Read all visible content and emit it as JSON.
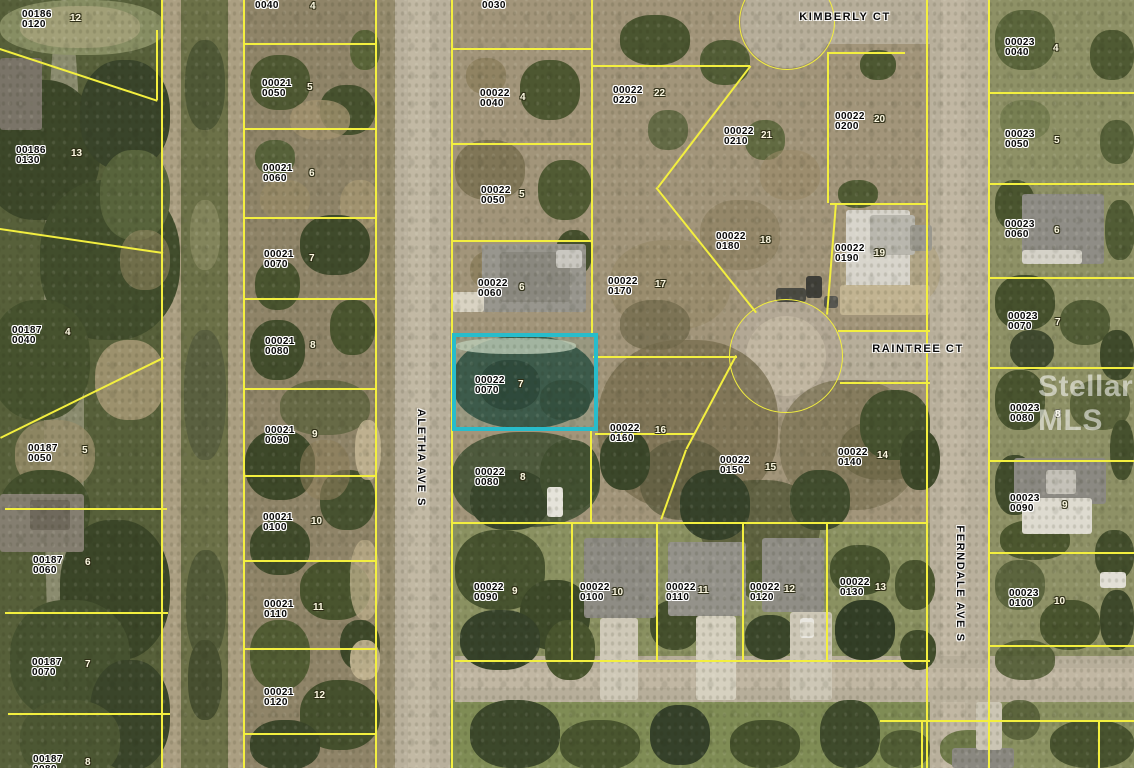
{
  "map_type": "aerial-parcel-map",
  "colors": {
    "boundary_line": "#f3ef3f",
    "highlight_border": "#28bccb",
    "parcel_label": "#050505",
    "lot_number": "#fdf9e3"
  },
  "watermark": {
    "text": "Stellar MLS"
  },
  "highlight": {
    "x": 452,
    "y": 333,
    "width": 146,
    "height": 98
  },
  "streets": [
    {
      "name": "KIMBERLY CT",
      "x": 845,
      "y": 17,
      "vertical": false
    },
    {
      "name": "RAINTREE CT",
      "x": 918,
      "y": 349,
      "vertical": false
    },
    {
      "name": "ALETHA AVE S",
      "x": 421,
      "y": 458,
      "vertical": true
    },
    {
      "name": "FERNDALE AVE S",
      "x": 960,
      "y": 584,
      "vertical": true
    }
  ],
  "parcels": [
    {
      "strap": "00186",
      "block": "0120",
      "x": 22,
      "y": 10
    },
    {
      "strap": "00186",
      "block": "0130",
      "x": 16,
      "y": 146
    },
    {
      "strap": "00187",
      "block": "0040",
      "x": 12,
      "y": 326
    },
    {
      "strap": "00187",
      "block": "0050",
      "x": 28,
      "y": 444
    },
    {
      "strap": "00187",
      "block": "0060",
      "x": 33,
      "y": 556
    },
    {
      "strap": "00187",
      "block": "0070",
      "x": 32,
      "y": 658
    },
    {
      "strap": "00187",
      "block": "0080",
      "x": 33,
      "y": 755
    },
    {
      "strap": "",
      "block": "0040",
      "x": 255,
      "y": 1
    },
    {
      "strap": "00021",
      "block": "0050",
      "x": 262,
      "y": 79
    },
    {
      "strap": "00021",
      "block": "0060",
      "x": 263,
      "y": 164
    },
    {
      "strap": "00021",
      "block": "0070",
      "x": 264,
      "y": 250
    },
    {
      "strap": "00021",
      "block": "0080",
      "x": 265,
      "y": 337
    },
    {
      "strap": "00021",
      "block": "0090",
      "x": 265,
      "y": 426
    },
    {
      "strap": "00021",
      "block": "0100",
      "x": 263,
      "y": 513
    },
    {
      "strap": "00021",
      "block": "0110",
      "x": 264,
      "y": 600
    },
    {
      "strap": "00021",
      "block": "0120",
      "x": 264,
      "y": 688
    },
    {
      "strap": "",
      "block": "0030",
      "x": 482,
      "y": 1
    },
    {
      "strap": "00022",
      "block": "0040",
      "x": 480,
      "y": 89
    },
    {
      "strap": "00022",
      "block": "0050",
      "x": 481,
      "y": 186
    },
    {
      "strap": "00022",
      "block": "0060",
      "x": 478,
      "y": 279
    },
    {
      "strap": "00022",
      "block": "0070",
      "x": 475,
      "y": 376
    },
    {
      "strap": "00022",
      "block": "0080",
      "x": 475,
      "y": 468
    },
    {
      "strap": "00022",
      "block": "0090",
      "x": 474,
      "y": 583
    },
    {
      "strap": "00022",
      "block": "0100",
      "x": 580,
      "y": 583
    },
    {
      "strap": "00022",
      "block": "0110",
      "x": 666,
      "y": 583
    },
    {
      "strap": "00022",
      "block": "0120",
      "x": 750,
      "y": 583
    },
    {
      "strap": "00022",
      "block": "0130",
      "x": 840,
      "y": 578
    },
    {
      "strap": "00022",
      "block": "0140",
      "x": 838,
      "y": 448
    },
    {
      "strap": "00022",
      "block": "0150",
      "x": 720,
      "y": 456
    },
    {
      "strap": "00022",
      "block": "0160",
      "x": 610,
      "y": 424
    },
    {
      "strap": "00022",
      "block": "0170",
      "x": 608,
      "y": 277
    },
    {
      "strap": "00022",
      "block": "0180",
      "x": 716,
      "y": 232
    },
    {
      "strap": "00022",
      "block": "0190",
      "x": 835,
      "y": 244
    },
    {
      "strap": "00022",
      "block": "0200",
      "x": 835,
      "y": 112
    },
    {
      "strap": "00022",
      "block": "0210",
      "x": 724,
      "y": 127
    },
    {
      "strap": "00022",
      "block": "0220",
      "x": 613,
      "y": 86
    },
    {
      "strap": "00023",
      "block": "0040",
      "x": 1005,
      "y": 38
    },
    {
      "strap": "00023",
      "block": "0050",
      "x": 1005,
      "y": 130
    },
    {
      "strap": "00023",
      "block": "0060",
      "x": 1005,
      "y": 220
    },
    {
      "strap": "00023",
      "block": "0070",
      "x": 1008,
      "y": 312
    },
    {
      "strap": "00023",
      "block": "0080",
      "x": 1010,
      "y": 404
    },
    {
      "strap": "00023",
      "block": "0090",
      "x": 1010,
      "y": 494
    },
    {
      "strap": "00023",
      "block": "0100",
      "x": 1009,
      "y": 589
    }
  ],
  "lots": [
    {
      "n": "12",
      "x": 70,
      "y": 14
    },
    {
      "n": "13",
      "x": 71,
      "y": 149
    },
    {
      "n": "4",
      "x": 65,
      "y": 328
    },
    {
      "n": "5",
      "x": 82,
      "y": 446
    },
    {
      "n": "6",
      "x": 85,
      "y": 558
    },
    {
      "n": "7",
      "x": 85,
      "y": 660
    },
    {
      "n": "8",
      "x": 85,
      "y": 758
    },
    {
      "n": "4",
      "x": 310,
      "y": 2
    },
    {
      "n": "5",
      "x": 307,
      "y": 83
    },
    {
      "n": "6",
      "x": 309,
      "y": 169
    },
    {
      "n": "7",
      "x": 309,
      "y": 254
    },
    {
      "n": "8",
      "x": 310,
      "y": 341
    },
    {
      "n": "9",
      "x": 312,
      "y": 430
    },
    {
      "n": "10",
      "x": 311,
      "y": 517
    },
    {
      "n": "11",
      "x": 313,
      "y": 603
    },
    {
      "n": "12",
      "x": 314,
      "y": 691
    },
    {
      "n": "4",
      "x": 520,
      "y": 93
    },
    {
      "n": "5",
      "x": 519,
      "y": 190
    },
    {
      "n": "6",
      "x": 519,
      "y": 283
    },
    {
      "n": "7",
      "x": 518,
      "y": 380
    },
    {
      "n": "8",
      "x": 520,
      "y": 473
    },
    {
      "n": "9",
      "x": 512,
      "y": 587
    },
    {
      "n": "10",
      "x": 612,
      "y": 588
    },
    {
      "n": "11",
      "x": 698,
      "y": 586
    },
    {
      "n": "12",
      "x": 784,
      "y": 585
    },
    {
      "n": "13",
      "x": 875,
      "y": 583
    },
    {
      "n": "14",
      "x": 877,
      "y": 451
    },
    {
      "n": "15",
      "x": 765,
      "y": 463
    },
    {
      "n": "16",
      "x": 655,
      "y": 426
    },
    {
      "n": "17",
      "x": 655,
      "y": 280
    },
    {
      "n": "18",
      "x": 760,
      "y": 236
    },
    {
      "n": "19",
      "x": 874,
      "y": 249
    },
    {
      "n": "20",
      "x": 874,
      "y": 115
    },
    {
      "n": "21",
      "x": 761,
      "y": 131
    },
    {
      "n": "22",
      "x": 654,
      "y": 89
    },
    {
      "n": "4",
      "x": 1053,
      "y": 44
    },
    {
      "n": "5",
      "x": 1054,
      "y": 136
    },
    {
      "n": "6",
      "x": 1054,
      "y": 226
    },
    {
      "n": "7",
      "x": 1055,
      "y": 318
    },
    {
      "n": "8",
      "x": 1055,
      "y": 410
    },
    {
      "n": "9",
      "x": 1062,
      "y": 501
    },
    {
      "n": "10",
      "x": 1054,
      "y": 597
    }
  ]
}
